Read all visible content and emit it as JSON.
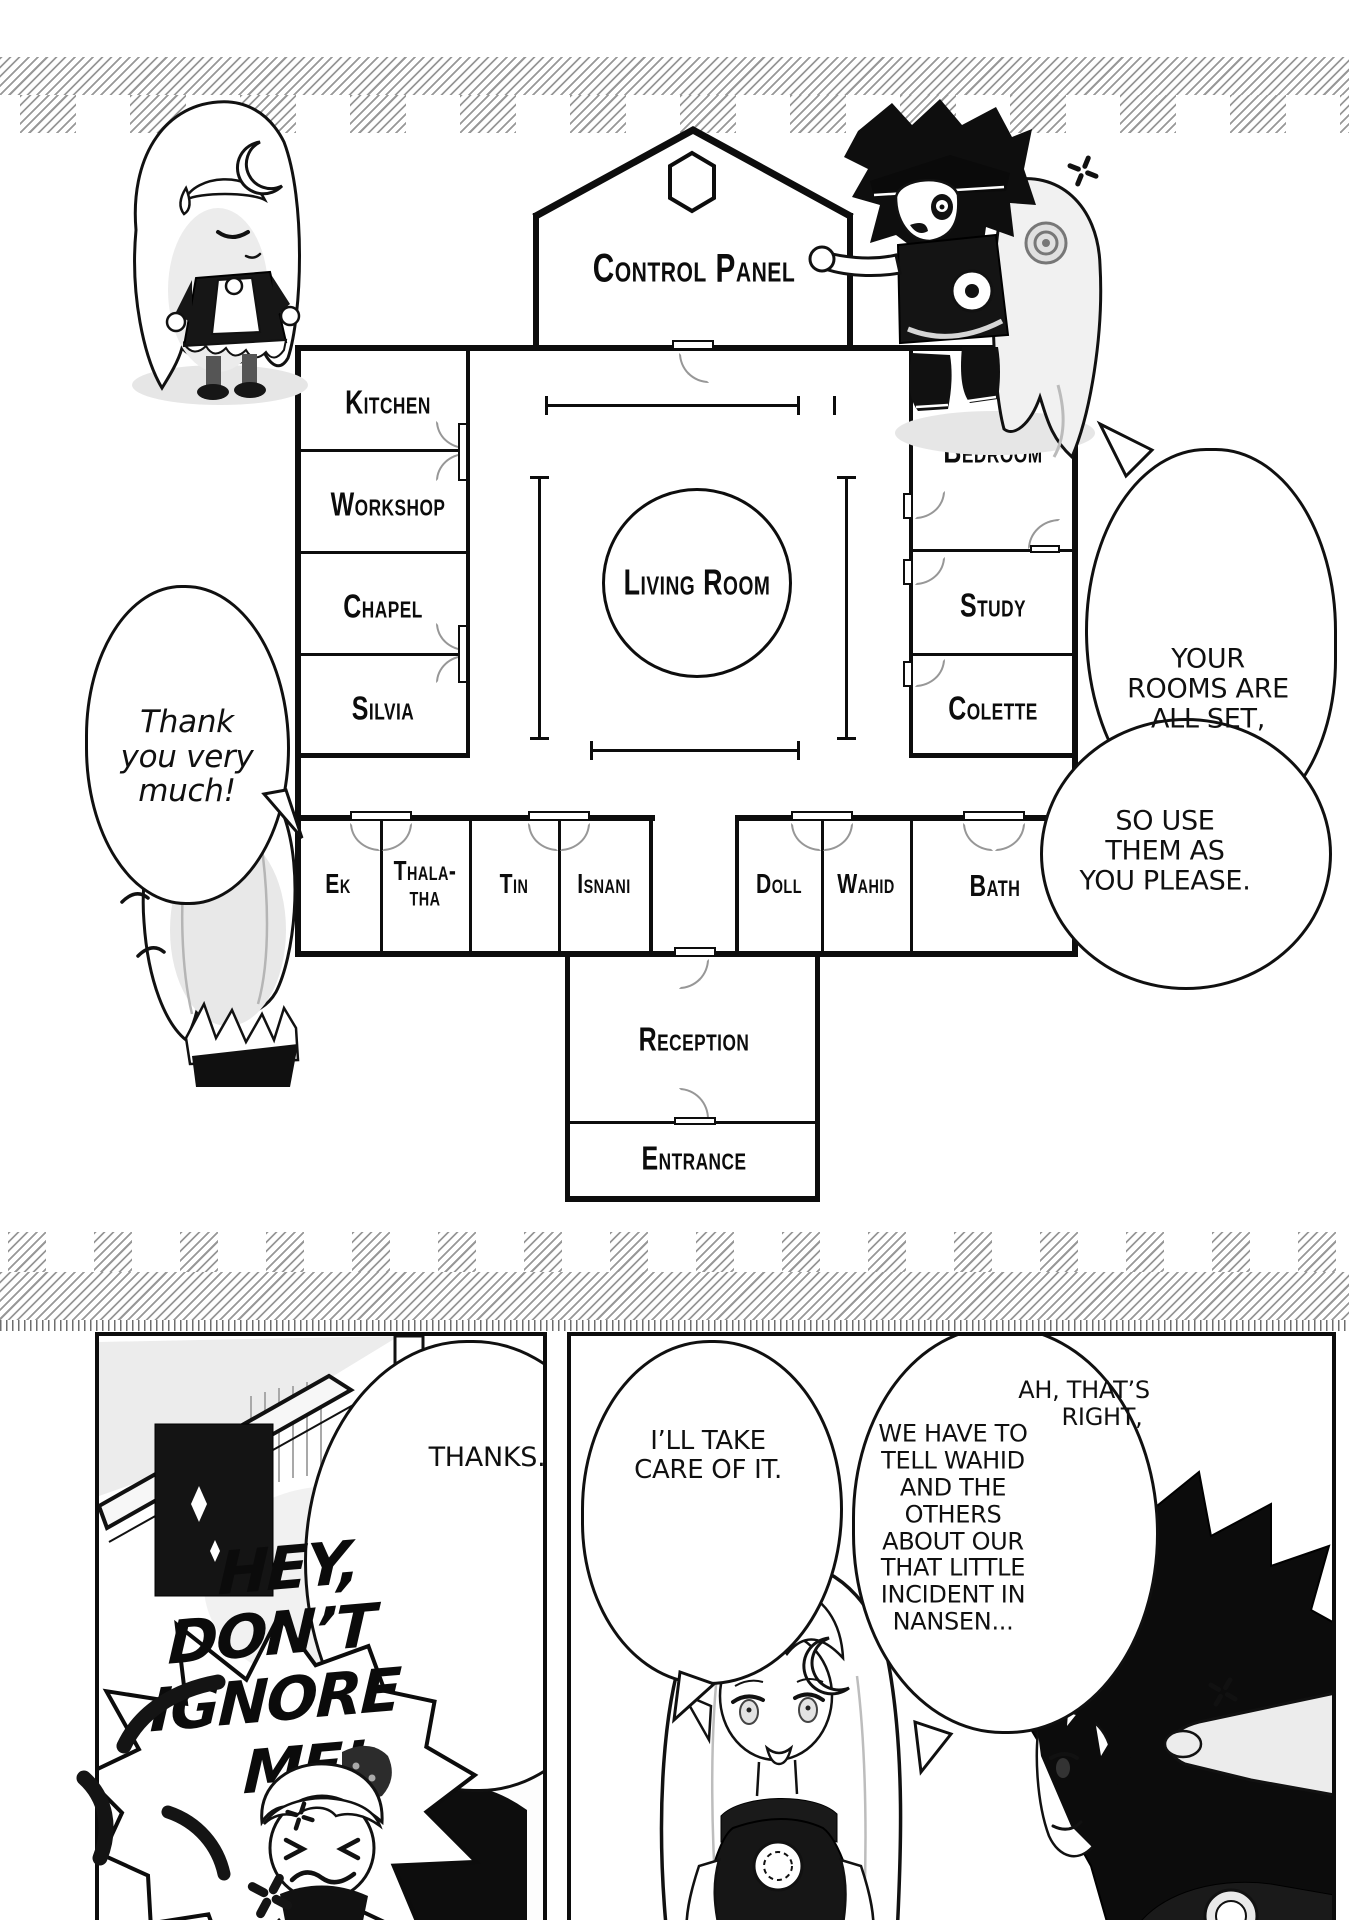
{
  "floor_plan": {
    "control_panel": "Control Panel",
    "living_room": "Living Room",
    "reception": "Reception",
    "entrance": "Entrance",
    "left_rooms": [
      {
        "label": "Kitchen"
      },
      {
        "label": "Workshop"
      },
      {
        "label": "Chapel"
      },
      {
        "label": "Silvia"
      }
    ],
    "right_rooms": [
      {
        "label": "Bedroom"
      },
      {
        "label": "Study"
      },
      {
        "label": "Colette"
      }
    ],
    "bottom_rooms": [
      {
        "label": "Ek"
      },
      {
        "label": "Thala-tha",
        "line1": "Thala-",
        "line2": "tha"
      },
      {
        "label": "Tin"
      },
      {
        "label": "Isnani"
      },
      {
        "label": "Doll"
      },
      {
        "label": "Wahid"
      },
      {
        "label": "Bath"
      }
    ]
  },
  "dialogue": {
    "thank_you": [
      "Thank",
      "you very",
      "much!"
    ],
    "rooms_set": [
      "YOUR",
      "ROOMS ARE",
      "ALL SET,"
    ],
    "use_please": [
      "SO USE",
      "THEM AS",
      "YOU PLEASE."
    ],
    "thanks": [
      "THANKS."
    ],
    "take_care": [
      "I’LL TAKE",
      "CARE OF IT."
    ],
    "ah_right": [
      "AH, THAT’S",
      "RIGHT,"
    ],
    "tell_wahid": [
      "WE HAVE TO",
      "TELL WAHID",
      "AND THE",
      "OTHERS",
      "ABOUT OUR",
      "THAT LITTLE",
      "INCIDENT IN",
      "NANSEN..."
    ],
    "hey": [
      "HEY,",
      "DON’T",
      "IGNORE",
      "ME!"
    ]
  }
}
